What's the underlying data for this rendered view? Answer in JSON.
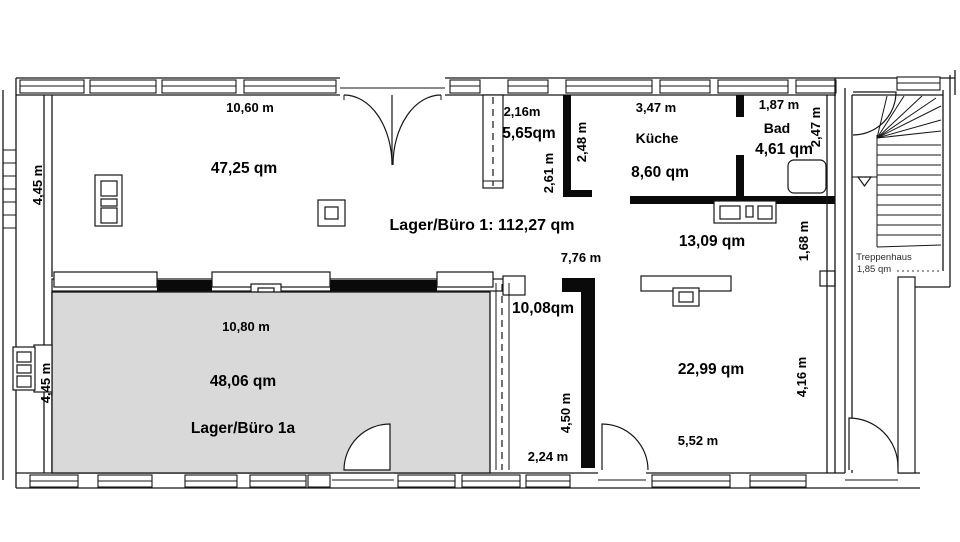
{
  "meta": {
    "type": "floor-plan",
    "title": "Lager/Büro Grundriss"
  },
  "colors": {
    "wall": "#0a0a0a",
    "line": "#161616",
    "highlight_room_fill": "#d9d9d9",
    "background": "#ffffff"
  },
  "labels": {
    "unit_total": "Lager/Büro 1: 112,27 qm",
    "room_main": {
      "area": "47,25 qm",
      "width": "10,60 m",
      "depth": "4,45 m"
    },
    "entry": {
      "area": "5,65qm",
      "width": "2,16m",
      "depth_left": "2,61 m",
      "depth_right": "2,48 m"
    },
    "kitchen": {
      "name": "Küche",
      "area": "8,60 qm",
      "width": "3,47 m"
    },
    "bath": {
      "name": "Bad",
      "area": "4,61 qm",
      "width": "1,87 m",
      "depth": "2,47 m"
    },
    "middle_room": {
      "area": "13,09 qm",
      "width": "7,76 m",
      "depth": "1,68 m"
    },
    "room_1a": {
      "name": "Lager/Büro 1a",
      "area": "48,06 qm",
      "width": "10,80 m",
      "depth": "4,45 m"
    },
    "corridor": {
      "area": "10,08qm",
      "depth": "4,50 m",
      "width": "2,24 m"
    },
    "rear_room": {
      "area": "22,99 qm",
      "width": "5,52 m",
      "depth": "4,16 m"
    },
    "staircase": {
      "name": "Treppenhaus",
      "area": "1,85 qm"
    }
  }
}
